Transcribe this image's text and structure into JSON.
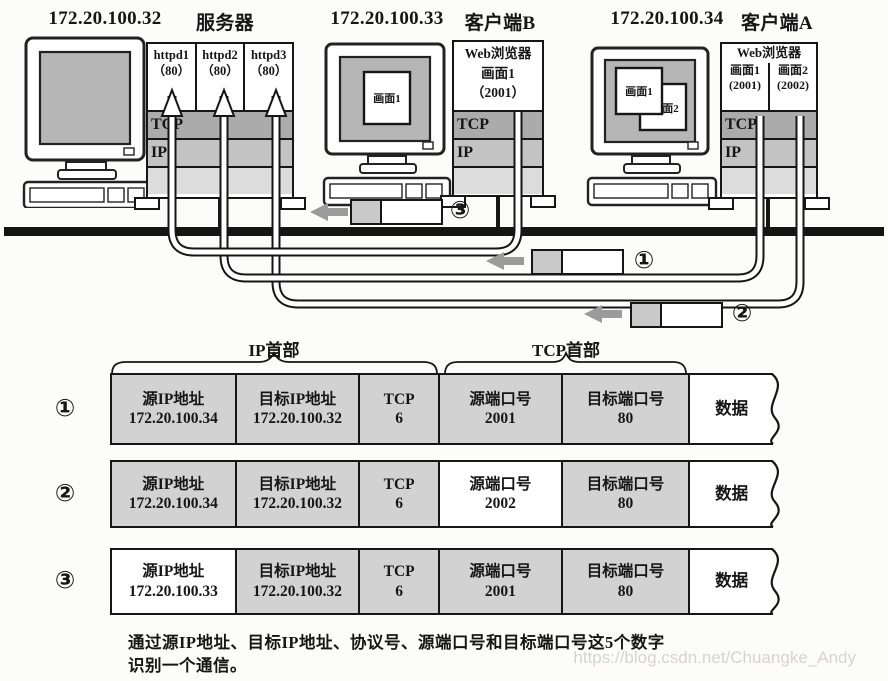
{
  "colors": {
    "tcp_band": "#ababab",
    "ip_band": "#c3c3c3",
    "phy_band": "#dcdcdc",
    "table_cell_gray": "#d2d2d2",
    "highlight_white": "#ffffff",
    "screen_gray": "#b6b6b6",
    "line_black": "#161616",
    "arrow_gray": "#9b9b9b"
  },
  "computers": [
    {
      "ip": "172.20.100.32",
      "title": "服务器",
      "stack": {
        "apps": [
          {
            "name": "httpd1",
            "port": "（80）"
          },
          {
            "name": "httpd2",
            "port": "（80）"
          },
          {
            "name": "httpd3",
            "port": "（80）"
          }
        ],
        "tcp_label": "TCP",
        "ip_label": "IP"
      }
    },
    {
      "ip": "172.20.100.33",
      "title": "客户端B",
      "screen_windows": [
        "画面1"
      ],
      "stack": {
        "browser": "Web浏览器",
        "sessions": [
          {
            "name": "画面1",
            "port": "（2001）"
          }
        ],
        "tcp_label": "TCP",
        "ip_label": "IP"
      }
    },
    {
      "ip": "172.20.100.34",
      "title": "客户端A",
      "screen_windows": [
        "画面1",
        "画面2"
      ],
      "stack": {
        "browser": "Web浏览器",
        "sessions": [
          {
            "name": "画面1",
            "port": "(2001)"
          },
          {
            "name": "画面2",
            "port": "(2002)"
          }
        ],
        "tcp_label": "TCP",
        "ip_label": "IP"
      }
    }
  ],
  "packets": [
    {
      "label": "③"
    },
    {
      "label": "①"
    },
    {
      "label": "②"
    }
  ],
  "table": {
    "header_groups": [
      {
        "label": "IP首部"
      },
      {
        "label": "TCP首部"
      }
    ],
    "rows": [
      {
        "label": "①",
        "cells": [
          {
            "title": "源IP地址",
            "value": "172.20.100.34",
            "highlight": false
          },
          {
            "title": "目标IP地址",
            "value": "172.20.100.32",
            "highlight": false
          },
          {
            "title": "TCP",
            "value": "6",
            "highlight": false
          },
          {
            "title": "源端口号",
            "value": "2001",
            "highlight": false
          },
          {
            "title": "目标端口号",
            "value": "80",
            "highlight": false
          },
          {
            "title": "数据",
            "value": "",
            "highlight": true
          }
        ]
      },
      {
        "label": "②",
        "cells": [
          {
            "title": "源IP地址",
            "value": "172.20.100.34",
            "highlight": false
          },
          {
            "title": "目标IP地址",
            "value": "172.20.100.32",
            "highlight": false
          },
          {
            "title": "TCP",
            "value": "6",
            "highlight": false
          },
          {
            "title": "源端口号",
            "value": "2002",
            "highlight": true
          },
          {
            "title": "目标端口号",
            "value": "80",
            "highlight": false
          },
          {
            "title": "数据",
            "value": "",
            "highlight": true
          }
        ]
      },
      {
        "label": "③",
        "cells": [
          {
            "title": "源IP地址",
            "value": "172.20.100.33",
            "highlight": true
          },
          {
            "title": "目标IP地址",
            "value": "172.20.100.32",
            "highlight": false
          },
          {
            "title": "TCP",
            "value": "6",
            "highlight": false
          },
          {
            "title": "源端口号",
            "value": "2001",
            "highlight": false
          },
          {
            "title": "目标端口号",
            "value": "80",
            "highlight": false
          },
          {
            "title": "数据",
            "value": "",
            "highlight": true
          }
        ]
      }
    ]
  },
  "caption": {
    "line1": "通过源IP地址、目标IP地址、协议号、源端口号和目标端口号这5个数字",
    "line2": "识别一个通信。"
  },
  "watermark": "https://blog.csdn.net/Chuangke_Andy"
}
